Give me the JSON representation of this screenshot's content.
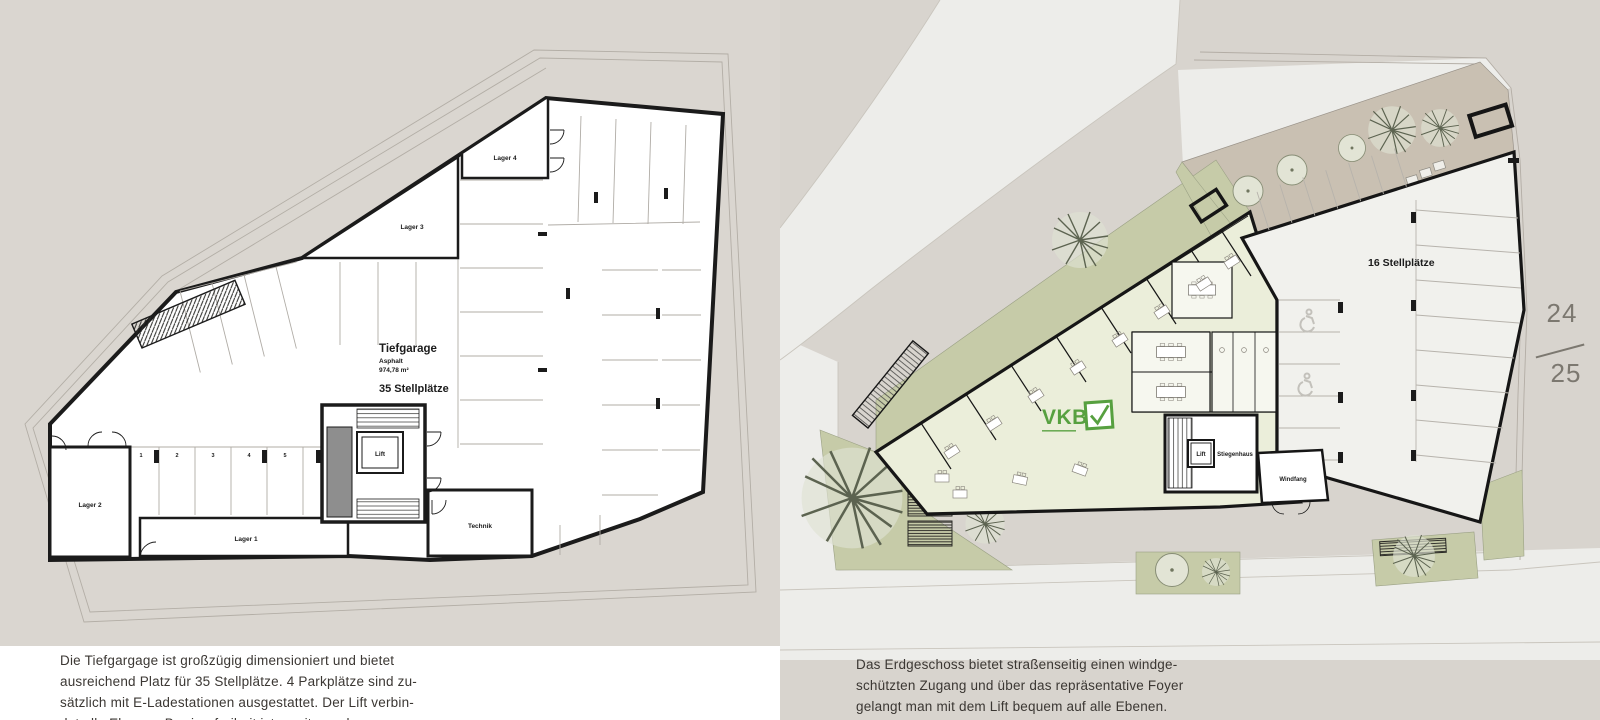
{
  "left_page": {
    "plan": {
      "title": "Tiefgarage",
      "surface": "Asphalt",
      "area": "974,78 m²",
      "capacity": "35 Stellplätze",
      "rooms": {
        "lager1": "Lager 1",
        "lager2": "Lager 2",
        "lager3": "Lager 3",
        "lager4": "Lager 4",
        "lift": "Lift",
        "technik": "Technik"
      },
      "stall_numbers": [
        "1",
        "2",
        "3",
        "4",
        "5",
        "6"
      ]
    },
    "caption": [
      "Die Tiefgargage ist großzügig dimensioniert und bietet",
      "ausreichend Platz für 35 Stellplätze. 4 Parkplätze sind zu-",
      "sätzlich mit E-Ladestationen ausgestattet. Der Lift verbin-",
      "det alle Ebenen, Barrierefreiheit ist somit gegeben."
    ]
  },
  "right_page": {
    "plan": {
      "parkdeck_label": "16 Stellplätze",
      "rooms": {
        "lift": "Lift",
        "stiegenhaus": "Stiegenhaus",
        "windfang": "Windfang"
      },
      "logo_text": "VKB"
    },
    "caption": [
      "Das Erdgeschoss bietet straßenseitig einen windge-",
      "schützten Zugang und über das repräsentative Foyer",
      "gelangt man mit dem Lift bequem auf alle Ebenen.",
      "Für Besucher steht ein überdachtes Parkdeck mit 16"
    ],
    "page_number": {
      "top": "24",
      "bottom": "25"
    }
  },
  "colors": {
    "page_beige": "#d9d5cf",
    "plan_white": "#ffffff",
    "wall_black": "#1b1b1b",
    "sage_green": "#c6cba8",
    "interior_green": "#ebeeda",
    "road_gray": "#ededea",
    "terrace_taupe": "#c9c0b2",
    "logo_green": "#57a040",
    "caption_text": "#3b3733",
    "page_number_gray": "#7c7870"
  }
}
